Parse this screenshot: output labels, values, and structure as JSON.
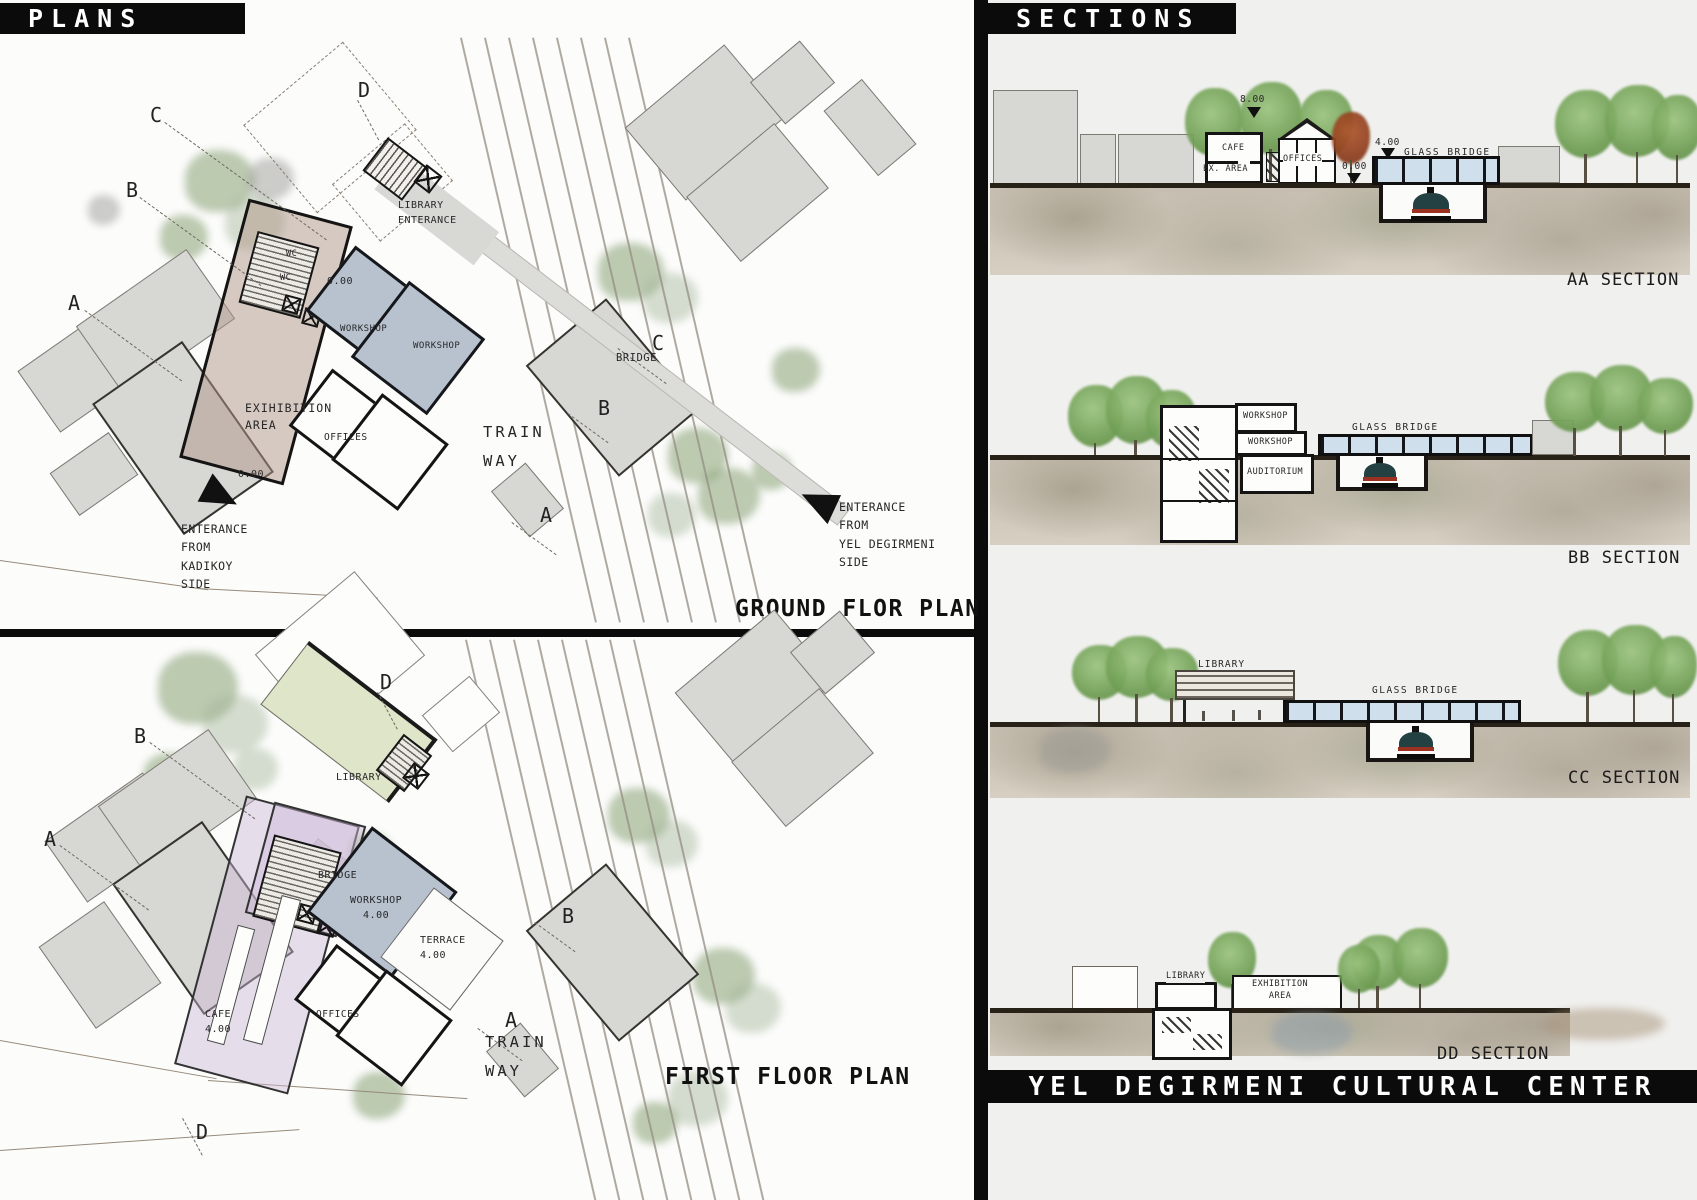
{
  "headers": {
    "plans": "PLANS",
    "sections": "SECTIONS",
    "footer": "YEL DEGIRMENI CULTURAL CENTER"
  },
  "ground_plan": {
    "title": "GROUND FLOR PLAN",
    "markers": {
      "d": "D",
      "c1": "C",
      "b1": "B",
      "a1": "A",
      "c2": "C",
      "b2": "B",
      "a2": "A"
    },
    "labels": {
      "library_ent": "LIBRARY\nENTERANCE",
      "wc1": "WC",
      "wc2": "WC",
      "lvl0a": "0.00",
      "lvl0b": "0.00",
      "ws1": "WORKSHOP",
      "ws2": "WORKSHOP",
      "exhibition": "EXIHIBITION\nAREA",
      "offices": "OFFICES",
      "bridge": "BRIDGE",
      "trainway": "TRAIN\nWAY",
      "ent_kadikoy": "ENTERANCE\nFROM\nKADIKOY\nSIDE",
      "ent_yel": "ENTERANCE\nFROM\nYEL DEGIRMENI\nSIDE"
    }
  },
  "first_plan": {
    "title": "FIRST FLOOR PLAN",
    "markers": {
      "d1": "D",
      "b1": "B",
      "a1": "A",
      "b2": "B",
      "a2": "A",
      "d2": "D"
    },
    "labels": {
      "library": "LIBRARY",
      "bridge": "BRIDGE",
      "workshop": "WORKSHOP\n4.00",
      "terrace": "TERRACE\n4.00",
      "cafe": "CAFE\n4.00",
      "offices": "OFFICES",
      "trainway": "TRAIN\nWAY"
    }
  },
  "sections": {
    "aa": {
      "label": "AA SECTION",
      "lv8": "8.00",
      "lv4": "4.00",
      "lv0": "0.00",
      "cafe": "CAFE",
      "ex_area": "EX. AREA",
      "offices": "OFFICES",
      "glass": "GLASS BRIDGE"
    },
    "bb": {
      "label": "BB SECTION",
      "ws1": "WORKSHOP",
      "ws2": "WORKSHOP",
      "auditorium": "AUDITORIUM",
      "glass": "GLASS BRIDGE"
    },
    "cc": {
      "label": "CC SECTION",
      "library": "LIBRARY",
      "glass": "GLASS BRIDGE"
    },
    "dd": {
      "label": "DD SECTION",
      "library": "LIBRARY",
      "exhibition": "EXHIBITION\nAREA"
    }
  },
  "colors": {
    "bar_black": "#0b0b0b",
    "panel_bg": "#f0f0ee",
    "library_green": "#dfe5c8",
    "first_floor_lavender": "#e2d8e8",
    "workshop_blue": "#b8c2cf",
    "exhibition_taupe": "#c9b7ad",
    "glass_blue": "#cfe0ec",
    "tree_green": "#6e9d53",
    "ground_wash": "#c6beb0",
    "train_teal": "#234043",
    "train_red": "#9c3122"
  }
}
